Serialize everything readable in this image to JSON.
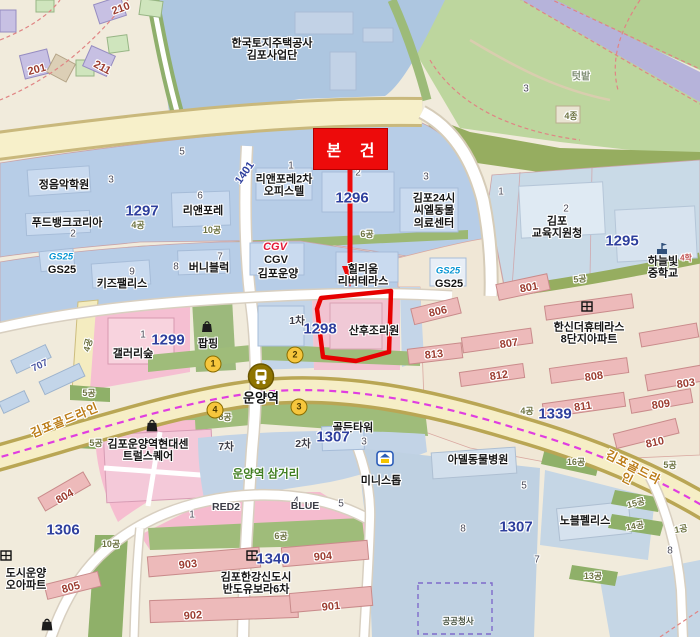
{
  "map": {
    "overlay": {
      "subject_box_label": "본 건"
    },
    "colors": {
      "background": "#f1ebdc",
      "water": "#adc6e0",
      "commercial_block": "#b7cde7",
      "public_block": "#c9dae7",
      "field_green": "#bdd69e",
      "buffer_green": "#96ad60",
      "station_green": "#9fbc7a",
      "pink_zone": "#f6bdd0",
      "pink_building": "#edbaba",
      "complex_cream": "#f0e7d6",
      "road_yellow": "#f6eec6",
      "stream_purple": "#b6b3da",
      "parcel_number_blue": "#2e3f9d",
      "building_number_red": "#9c3c30",
      "subject_red": "#ed0b0b",
      "metro_line_magenta": "#e03ee0"
    },
    "station": {
      "name": "운양역",
      "exits": [
        {
          "n": "1",
          "x": 213,
          "y": 364
        },
        {
          "n": "2",
          "x": 295,
          "y": 355
        },
        {
          "n": "3",
          "x": 299,
          "y": 407
        },
        {
          "n": "4",
          "x": 215,
          "y": 410
        }
      ]
    },
    "roads": [
      {
        "name": "김포골드라인"
      }
    ],
    "subject_parcel": {
      "number": "1298",
      "poi": "산후조리원"
    },
    "labels": [
      {
        "t": "한국토지주택공사\n김포사업단",
        "x": 272,
        "y": 50,
        "c": "poi"
      },
      {
        "t": "210",
        "x": 121,
        "y": 9,
        "c": "bred",
        "r": -20
      },
      {
        "t": "201",
        "x": 37,
        "y": 70,
        "c": "bred",
        "r": -15
      },
      {
        "t": "211",
        "x": 102,
        "y": 68,
        "c": "bred",
        "r": 28
      },
      {
        "t": "텃밭",
        "x": 581,
        "y": 77,
        "c": "ttb"
      },
      {
        "t": "3",
        "x": 526,
        "y": 89,
        "c": "num"
      },
      {
        "t": "4종",
        "x": 571,
        "y": 116,
        "c": "zone"
      },
      {
        "t": "5",
        "x": 182,
        "y": 152,
        "c": "num"
      },
      {
        "t": "정음악학원",
        "x": 64,
        "y": 185,
        "c": "poi"
      },
      {
        "t": "3",
        "x": 111,
        "y": 180,
        "c": "num"
      },
      {
        "t": "푸드뱅크코리아",
        "x": 67,
        "y": 223,
        "c": "poi"
      },
      {
        "t": "2",
        "x": 73,
        "y": 234,
        "c": "num"
      },
      {
        "t": "1297",
        "x": 142,
        "y": 212,
        "c": "pnum"
      },
      {
        "t": "4공",
        "x": 138,
        "y": 225,
        "c": "zone"
      },
      {
        "t": "리앤포레",
        "x": 203,
        "y": 211,
        "c": "poi"
      },
      {
        "t": "6",
        "x": 200,
        "y": 196,
        "c": "num"
      },
      {
        "t": "10공",
        "x": 212,
        "y": 230,
        "c": "zone"
      },
      {
        "t": "1401",
        "x": 245,
        "y": 173,
        "c": "pnum-sm",
        "r": -55
      },
      {
        "t": "리앤포레2차\n오피스텔",
        "x": 284,
        "y": 186,
        "c": "poi"
      },
      {
        "t": "1",
        "x": 291,
        "y": 166,
        "c": "num"
      },
      {
        "t": "1296",
        "x": 352,
        "y": 199,
        "c": "pnum"
      },
      {
        "t": "2",
        "x": 358,
        "y": 173,
        "c": "num"
      },
      {
        "t": "김포24시\n씨엘동물\n의료센터",
        "x": 434,
        "y": 211,
        "c": "poi"
      },
      {
        "t": "3",
        "x": 426,
        "y": 177,
        "c": "num"
      },
      {
        "t": "김포\n교육지원청",
        "x": 557,
        "y": 228,
        "c": "poi"
      },
      {
        "t": "1",
        "x": 501,
        "y": 192,
        "c": "num"
      },
      {
        "t": "2",
        "x": 566,
        "y": 209,
        "c": "num"
      },
      {
        "t": "1295",
        "x": 622,
        "y": 242,
        "c": "pnum"
      },
      {
        "t": "하늘빛중학교",
        "x": 663,
        "y": 268,
        "c": "poi"
      },
      {
        "t": "4학",
        "x": 686,
        "y": 259,
        "c": "tinyred"
      },
      {
        "t": "GS25",
        "x": 61,
        "y": 258,
        "c": "gs"
      },
      {
        "t": "GS25",
        "x": 62,
        "y": 270,
        "c": "gsname"
      },
      {
        "t": "키즈팰리스",
        "x": 122,
        "y": 284,
        "c": "poi"
      },
      {
        "t": "9",
        "x": 132,
        "y": 272,
        "c": "num"
      },
      {
        "t": "버니블럭",
        "x": 209,
        "y": 268,
        "c": "poi"
      },
      {
        "t": "8",
        "x": 176,
        "y": 267,
        "c": "num"
      },
      {
        "t": "7",
        "x": 220,
        "y": 257,
        "c": "num"
      },
      {
        "t": "CGV",
        "x": 275,
        "y": 247,
        "c": "cgv"
      },
      {
        "t": "CGV",
        "x": 276,
        "y": 260,
        "c": "poi"
      },
      {
        "t": "김포운양",
        "x": 278,
        "y": 274,
        "c": "poi"
      },
      {
        "t": "힐리움\n리버테라스",
        "x": 363,
        "y": 276,
        "c": "poi"
      },
      {
        "t": "GS25",
        "x": 448,
        "y": 272,
        "c": "gs"
      },
      {
        "t": "GS25",
        "x": 449,
        "y": 284,
        "c": "gsname"
      },
      {
        "t": "6공",
        "x": 367,
        "y": 234,
        "c": "zone"
      },
      {
        "t": "801",
        "x": 529,
        "y": 288,
        "c": "bred",
        "r": -10
      },
      {
        "t": "5공",
        "x": 580,
        "y": 279,
        "c": "zone",
        "r": -6
      },
      {
        "t": "806",
        "x": 438,
        "y": 312,
        "c": "bred",
        "r": -12
      },
      {
        "t": "813",
        "x": 434,
        "y": 355,
        "c": "bred",
        "r": -6
      },
      {
        "t": "한신더휴테라스\n8단지아파트",
        "x": 589,
        "y": 334,
        "c": "poi"
      },
      {
        "t": "807",
        "x": 509,
        "y": 344,
        "c": "bred",
        "r": -8
      },
      {
        "t": "812",
        "x": 499,
        "y": 376,
        "c": "bred",
        "r": -8
      },
      {
        "t": "808",
        "x": 594,
        "y": 377,
        "c": "bred",
        "r": -8
      },
      {
        "t": "811",
        "x": 583,
        "y": 407,
        "c": "bred",
        "r": -8
      },
      {
        "t": "803",
        "x": 686,
        "y": 384,
        "c": "bred",
        "r": -8
      },
      {
        "t": "809",
        "x": 661,
        "y": 405,
        "c": "bred",
        "r": -8
      },
      {
        "t": "810",
        "x": 655,
        "y": 443,
        "c": "bred",
        "r": -12
      },
      {
        "t": "1339",
        "x": 555,
        "y": 415,
        "c": "pnum"
      },
      {
        "t": "4공",
        "x": 527,
        "y": 411,
        "c": "zone"
      },
      {
        "t": "1298",
        "x": 320,
        "y": 330,
        "c": "pnum"
      },
      {
        "t": "산후조리원",
        "x": 374,
        "y": 331,
        "c": "poi"
      },
      {
        "t": "1차",
        "x": 297,
        "y": 322,
        "c": "gray"
      },
      {
        "t": "팝핑",
        "x": 208,
        "y": 344,
        "c": "poi"
      },
      {
        "t": "1299",
        "x": 168,
        "y": 341,
        "c": "pnum"
      },
      {
        "t": "갤러리숲",
        "x": 133,
        "y": 354,
        "c": "poi"
      },
      {
        "t": "1",
        "x": 143,
        "y": 335,
        "c": "num"
      },
      {
        "t": "4공",
        "x": 88,
        "y": 345,
        "c": "zone",
        "r": -75
      },
      {
        "t": "707",
        "x": 40,
        "y": 366,
        "c": "bblue",
        "r": -25
      },
      {
        "t": "5공",
        "x": 89,
        "y": 393,
        "c": "zone"
      },
      {
        "t": "김포골드라인",
        "x": 65,
        "y": 421,
        "c": "road",
        "r": -22
      },
      {
        "t": "5공",
        "x": 96,
        "y": 443,
        "c": "zone"
      },
      {
        "t": "운양역",
        "x": 261,
        "y": 399,
        "c": "station"
      },
      {
        "t": "8공",
        "x": 225,
        "y": 417,
        "c": "zone"
      },
      {
        "t": "김포운양역현대센\n트럴스퀘어",
        "x": 148,
        "y": 451,
        "c": "poi"
      },
      {
        "t": "804",
        "x": 65,
        "y": 497,
        "c": "bred",
        "r": -30
      },
      {
        "t": "1306",
        "x": 63,
        "y": 531,
        "c": "pnum"
      },
      {
        "t": "도시운양\n오아파트",
        "x": 26,
        "y": 580,
        "c": "poi"
      },
      {
        "t": "805",
        "x": 71,
        "y": 588,
        "c": "bred",
        "r": -15
      },
      {
        "t": "10공",
        "x": 111,
        "y": 544,
        "c": "zone"
      },
      {
        "t": "운양역 삼거리",
        "x": 266,
        "y": 475,
        "c": "green"
      },
      {
        "t": "1",
        "x": 192,
        "y": 515,
        "c": "num"
      },
      {
        "t": "RED2",
        "x": 226,
        "y": 508,
        "c": "gray"
      },
      {
        "t": "4",
        "x": 296,
        "y": 501,
        "c": "num"
      },
      {
        "t": "BLUE",
        "x": 305,
        "y": 507,
        "c": "gray"
      },
      {
        "t": "5",
        "x": 341,
        "y": 504,
        "c": "num"
      },
      {
        "t": "6공",
        "x": 281,
        "y": 536,
        "c": "zone"
      },
      {
        "t": "903",
        "x": 188,
        "y": 565,
        "c": "bred",
        "r": -6
      },
      {
        "t": "904",
        "x": 323,
        "y": 557,
        "c": "bred",
        "r": -5
      },
      {
        "t": "1340",
        "x": 273,
        "y": 560,
        "c": "pnum"
      },
      {
        "t": "김포한강신도시\n반도유보라6차",
        "x": 256,
        "y": 584,
        "c": "poi"
      },
      {
        "t": "902",
        "x": 193,
        "y": 616,
        "c": "bred",
        "r": -4
      },
      {
        "t": "901",
        "x": 331,
        "y": 607,
        "c": "bred",
        "r": -6
      },
      {
        "t": "골든타워",
        "x": 353,
        "y": 428,
        "c": "poi"
      },
      {
        "t": "1307",
        "x": 333,
        "y": 438,
        "c": "pnum"
      },
      {
        "t": "3",
        "x": 364,
        "y": 442,
        "c": "num"
      },
      {
        "t": "7차",
        "x": 226,
        "y": 448,
        "c": "gray"
      },
      {
        "t": "2차",
        "x": 303,
        "y": 445,
        "c": "gray"
      },
      {
        "t": "미니스톱",
        "x": 381,
        "y": 481,
        "c": "poi"
      },
      {
        "t": "아델동물병원",
        "x": 478,
        "y": 460,
        "c": "poi"
      },
      {
        "t": "5",
        "x": 524,
        "y": 486,
        "c": "num"
      },
      {
        "t": "1307",
        "x": 516,
        "y": 528,
        "c": "pnum"
      },
      {
        "t": "8",
        "x": 463,
        "y": 529,
        "c": "num"
      },
      {
        "t": "7",
        "x": 537,
        "y": 560,
        "c": "num"
      },
      {
        "t": "노블펠리스",
        "x": 585,
        "y": 521,
        "c": "poi"
      },
      {
        "t": "16공",
        "x": 576,
        "y": 462,
        "c": "zone"
      },
      {
        "t": "15공",
        "x": 636,
        "y": 503,
        "c": "zone",
        "r": -14
      },
      {
        "t": "14공",
        "x": 635,
        "y": 526,
        "c": "zone",
        "r": -10
      },
      {
        "t": "1공",
        "x": 681,
        "y": 529,
        "c": "zone",
        "r": -10
      },
      {
        "t": "8",
        "x": 670,
        "y": 551,
        "c": "num"
      },
      {
        "t": "13공",
        "x": 593,
        "y": 576,
        "c": "zone"
      },
      {
        "t": "김포골드라인",
        "x": 630,
        "y": 474,
        "c": "road",
        "r": 27
      },
      {
        "t": "5공",
        "x": 670,
        "y": 465,
        "c": "zone"
      },
      {
        "t": "공공청사",
        "x": 458,
        "y": 622,
        "c": "poi-xs"
      }
    ],
    "icons": [
      "station-icon",
      "exit-circle",
      "shopping-bag-icon",
      "apartment-icon",
      "school-icon",
      "ministop-icon"
    ]
  }
}
